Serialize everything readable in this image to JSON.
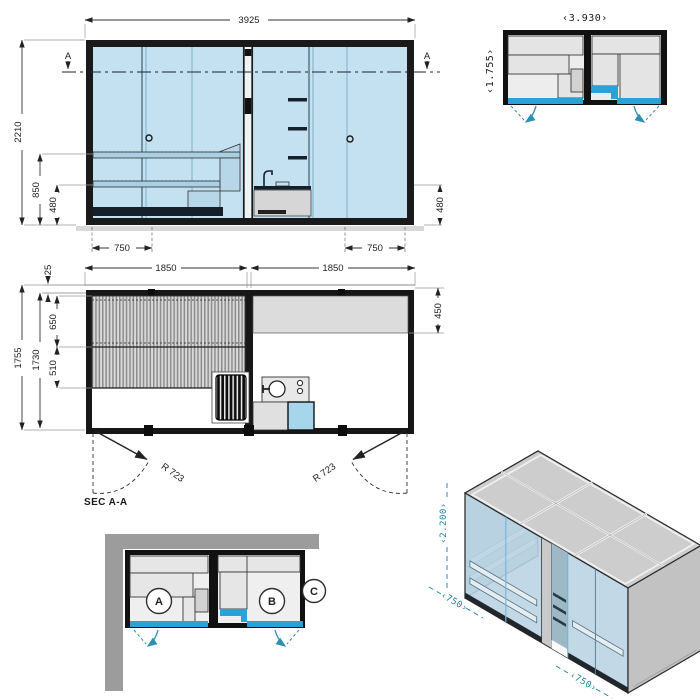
{
  "colors": {
    "accent_blue": "#2aa2d6",
    "teal_label": "#1f7f9c",
    "glass_blue": "#c3e1f0",
    "frame_dark": "#1a1a1a",
    "wall_gray": "#9c9c9c"
  },
  "elevation_view": {
    "dim_width": "3925",
    "dim_height": "2210",
    "dim_bench_high": "850",
    "dim_bench_low": "480",
    "dim_bench_low_right": "480",
    "dim_door_left": "750",
    "dim_door_right": "750",
    "section_marker_left": "A",
    "section_marker_right": "A"
  },
  "plan_view": {
    "dim_room_left": "1850",
    "dim_room_right": "1850",
    "dim_depth_total": "1755",
    "dim_depth_inner": "1730",
    "dim_bench_upper": "650",
    "dim_bench_lower": "510",
    "dim_roof_edge": "25",
    "dim_counter_depth": "450",
    "door_swing_left": "R 723",
    "door_swing_right": "R 723",
    "section_label": "SEC A-A"
  },
  "overview_plan": {
    "dim_width": "‹3.930›",
    "dim_depth": "‹1.755›"
  },
  "placement_plan": {
    "room_a_label": "A",
    "room_b_label": "B",
    "panel_c_label": "C"
  },
  "isometric_view": {
    "dim_height": "‹2.200›",
    "dim_door_left": "‹750›",
    "dim_door_right": "‹750›"
  }
}
